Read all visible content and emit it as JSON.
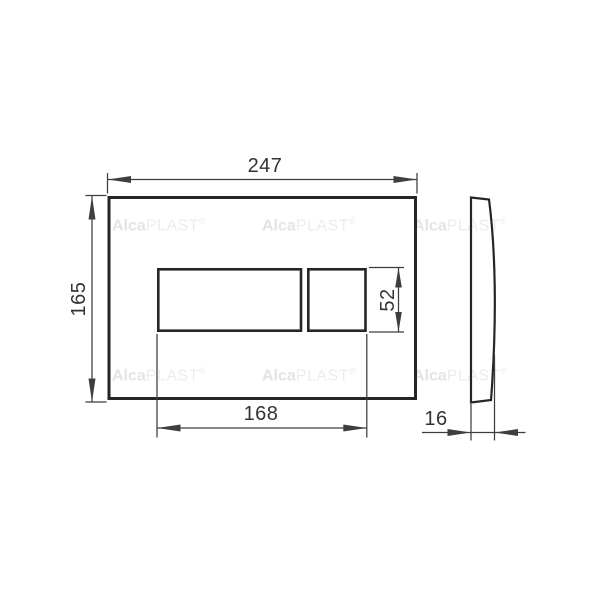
{
  "drawing_labels": {
    "overall_width": "247",
    "overall_height": "165",
    "button_group_width": "168",
    "button_height": "52",
    "plate_depth": "16"
  },
  "watermark": {
    "brand_bold": "Alca",
    "brand_rest": "PLAST",
    "registered_mark": "®"
  },
  "colors": {
    "background": "#ffffff",
    "main_line": "#262626",
    "dim_line": "#3e3e3e",
    "label_text": "#333333",
    "watermark_bold": "#e4e4e4",
    "watermark_light": "#ececec"
  }
}
